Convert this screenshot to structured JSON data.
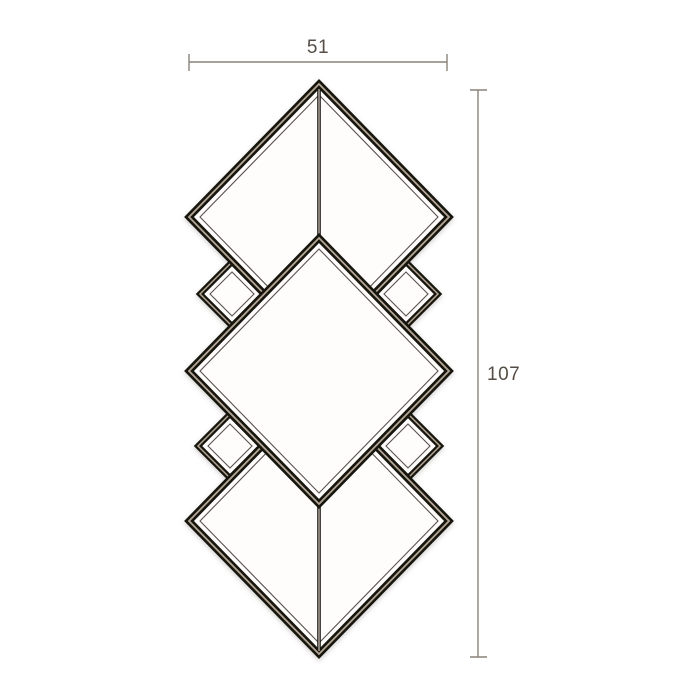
{
  "diagram": {
    "kind": "product-dimension-drawing",
    "subject": "art-deco-stacked-diamond-wall-mirror",
    "width_label": "51",
    "height_label": "107"
  },
  "colors": {
    "background": "#ffffff",
    "dimension_line": "#8c8279",
    "dimension_text": "#564e46",
    "frame_dark": "#16120f",
    "frame_highlight": "#b4a697",
    "mirror_face": "#fefdfc"
  }
}
